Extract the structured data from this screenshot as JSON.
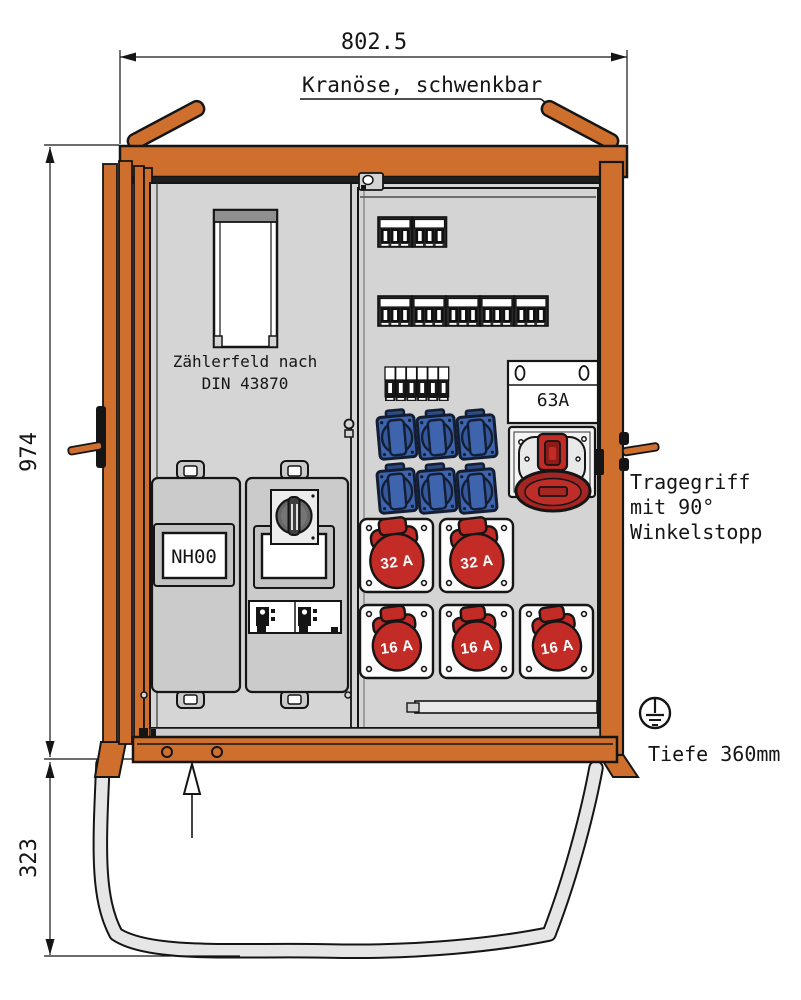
{
  "dimensions": {
    "width": "802.5",
    "height": "974",
    "stand_height": "323",
    "depth": "Tiefe 360mm"
  },
  "labels": {
    "crane_eye": "Kranöse, schwenkbar",
    "meter_line1": "Zählerfeld nach",
    "meter_line2": "DIN 43870",
    "nh_fuse": "NH00",
    "main_breaker": "63A",
    "handle_line1": "Tragegriff",
    "handle_line2": "mit 90°",
    "handle_line3": "Winkelstopp"
  },
  "sockets": {
    "cee32": [
      "32 A",
      "32 A"
    ],
    "cee16": [
      "16 A",
      "16 A",
      "16 A"
    ]
  },
  "colors": {
    "frame_orange": "#cf6f2d",
    "socket_red": "#c32b27",
    "socket_blue": "#3d64ad",
    "panel_gray": "#d5d5d5"
  }
}
